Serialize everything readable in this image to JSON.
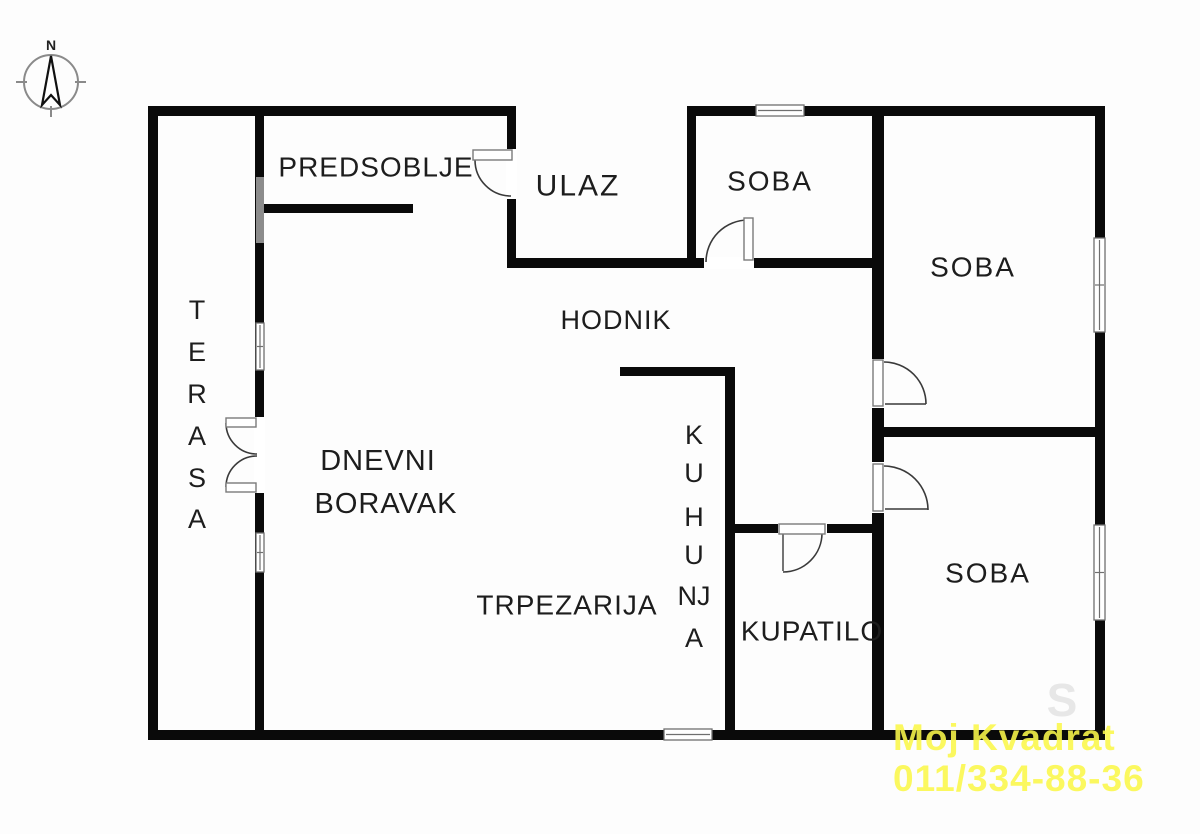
{
  "plan": {
    "bg": "#fdfdfd",
    "wall_color": "#0a0a0a",
    "line_color": "#3a3a3a",
    "window_stroke": "#6f6f6f",
    "label_color": "#1d1d1d",
    "ghosts": [
      {
        "text": "S",
        "x": 1062,
        "y": 716,
        "size": 46,
        "color": "#e7e7e7"
      }
    ],
    "walls": [
      {
        "name": "top-wall-left",
        "x": 148,
        "y": 106,
        "w": 367,
        "h": 10
      },
      {
        "name": "top-wall-right",
        "x": 687,
        "y": 106,
        "w": 418,
        "h": 10
      },
      {
        "name": "left-outer-wall",
        "x": 148,
        "y": 106,
        "w": 10,
        "h": 634
      },
      {
        "name": "right-outer-wall",
        "x": 1095,
        "y": 106,
        "w": 10,
        "h": 634
      },
      {
        "name": "bottom-outer-wall",
        "x": 148,
        "y": 730,
        "w": 957,
        "h": 10
      },
      {
        "name": "terrace-wall",
        "x": 255,
        "y": 106,
        "w": 9,
        "h": 634
      },
      {
        "name": "entry-wall",
        "x": 507,
        "y": 106,
        "w": 9,
        "h": 162
      },
      {
        "name": "soba1-left-wall",
        "x": 687,
        "y": 106,
        "w": 9,
        "h": 162
      },
      {
        "name": "hall-top-wall",
        "x": 507,
        "y": 258,
        "w": 377,
        "h": 10
      },
      {
        "name": "rooms-left-wall",
        "x": 872,
        "y": 106,
        "w": 12,
        "h": 634
      },
      {
        "name": "soba-divider-wall",
        "x": 872,
        "y": 427,
        "w": 233,
        "h": 10
      },
      {
        "name": "predsoblje-wall",
        "x": 262,
        "y": 204,
        "w": 151,
        "h": 9
      },
      {
        "name": "kitchen-top-wall",
        "x": 620,
        "y": 367,
        "w": 114,
        "h": 9
      },
      {
        "name": "kitchen-right-wall",
        "x": 725,
        "y": 367,
        "w": 10,
        "h": 373
      },
      {
        "name": "bathroom-top-wall",
        "x": 725,
        "y": 524,
        "w": 159,
        "h": 9
      }
    ],
    "solids": [
      {
        "name": "terrace-window-upper",
        "x": 256,
        "y": 177,
        "w": 8,
        "h": 66,
        "color": "#8c8c8c"
      }
    ],
    "windows": [
      {
        "name": "soba1-top-window",
        "x": 756,
        "y": 105,
        "w": 48,
        "h": 11,
        "o": "h"
      },
      {
        "name": "soba2-right-window",
        "x": 1094,
        "y": 238,
        "w": 11,
        "h": 94,
        "o": "v"
      },
      {
        "name": "soba3-right-window",
        "x": 1094,
        "y": 525,
        "w": 11,
        "h": 95,
        "o": "v"
      },
      {
        "name": "kitchen-bottom-window",
        "x": 664,
        "y": 729,
        "w": 48,
        "h": 11,
        "o": "h"
      },
      {
        "name": "terrace-window-mid",
        "x": 256,
        "y": 323,
        "w": 8,
        "h": 47,
        "o": "v"
      },
      {
        "name": "terrace-window-lower",
        "x": 256,
        "y": 533,
        "w": 8,
        "h": 39,
        "o": "v"
      }
    ],
    "doors": [
      {
        "name": "entry-door",
        "gap": {
          "x": 506,
          "y": 149,
          "w": 11,
          "h": 50
        },
        "leaf": {
          "x": 473,
          "y": 150,
          "w": 39,
          "h": 10
        },
        "arc": "M 475 160 A 36 36 0 0 0 511 196"
      },
      {
        "name": "soba1-door",
        "gap": {
          "x": 704,
          "y": 257,
          "w": 50,
          "h": 12
        },
        "leaf": {
          "x": 744,
          "y": 218,
          "w": 9,
          "h": 42
        },
        "arc": "M 706 262 A 42 42 0 0 1 748 220"
      },
      {
        "name": "soba2-door",
        "gap": {
          "x": 871,
          "y": 359,
          "w": 14,
          "h": 49
        },
        "leaf": {
          "x": 873,
          "y": 360,
          "w": 10,
          "h": 46
        },
        "arc": "M 884 362 A 42 42 0 0 1 926 404",
        "line": [
          885,
          404,
          926,
          404
        ]
      },
      {
        "name": "soba3-door",
        "gap": {
          "x": 871,
          "y": 462,
          "w": 14,
          "h": 51
        },
        "leaf": {
          "x": 873,
          "y": 464,
          "w": 10,
          "h": 47
        },
        "arc": "M 884 466 A 44 44 0 0 1 928 510",
        "line": [
          885,
          509,
          928,
          509
        ]
      },
      {
        "name": "bathroom-door",
        "gap": {
          "x": 778,
          "y": 523,
          "w": 49,
          "h": 11
        },
        "leaf": {
          "x": 779,
          "y": 524,
          "w": 46,
          "h": 10
        },
        "arc": "M 783 572 A 39 39 0 0 0 822 533",
        "line": [
          783,
          534,
          783,
          571
        ]
      },
      {
        "name": "balcony-door-upper",
        "gap": {
          "x": 254,
          "y": 417,
          "w": 11,
          "h": 76
        },
        "leaf": {
          "x": 226,
          "y": 418,
          "w": 30,
          "h": 9
        },
        "arc": "M 226 423 A 31 31 0 0 0 257 454"
      },
      {
        "name": "balcony-door-lower",
        "gap": null,
        "leaf": {
          "x": 226,
          "y": 483,
          "w": 30,
          "h": 9
        },
        "arc": "M 226 487 A 31 31 0 0 1 257 456"
      }
    ],
    "labels": [
      {
        "name": "label-predsoblje",
        "text": "PREDSOBLJE",
        "x": 376,
        "y": 167,
        "size": 28,
        "ls": 1
      },
      {
        "name": "label-ulaz",
        "text": "ULAZ",
        "x": 578,
        "y": 186,
        "size": 30,
        "ls": 2
      },
      {
        "name": "label-soba-1",
        "text": "SOBA",
        "x": 770,
        "y": 181,
        "size": 28,
        "ls": 2
      },
      {
        "name": "label-soba-2",
        "text": "SOBA",
        "x": 973,
        "y": 267,
        "size": 28,
        "ls": 2
      },
      {
        "name": "label-hodnik",
        "text": "HODNIK",
        "x": 616,
        "y": 320,
        "size": 27,
        "ls": 1
      },
      {
        "name": "label-dnevni",
        "text": "DNEVNI",
        "x": 378,
        "y": 461,
        "size": 29,
        "ls": 1
      },
      {
        "name": "label-boravak",
        "text": "BORAVAK",
        "x": 386,
        "y": 504,
        "size": 29,
        "ls": 1
      },
      {
        "name": "label-trpezarija",
        "text": "TRPEZARIJA",
        "x": 567,
        "y": 605,
        "size": 28,
        "ls": 1
      },
      {
        "name": "label-kupatilo",
        "text": "KUPATILO",
        "x": 812,
        "y": 631,
        "size": 28,
        "ls": 1
      },
      {
        "name": "label-soba-3",
        "text": "SOBA",
        "x": 988,
        "y": 573,
        "size": 28,
        "ls": 2
      }
    ],
    "vlabels": [
      {
        "name": "label-terasa",
        "x": 197,
        "size": 27,
        "letters": [
          {
            "t": "T",
            "y": 310
          },
          {
            "t": "E",
            "y": 352
          },
          {
            "t": "R",
            "y": 394
          },
          {
            "t": "A",
            "y": 436
          },
          {
            "t": "S",
            "y": 478
          },
          {
            "t": "A",
            "y": 519
          }
        ]
      },
      {
        "name": "label-kuhinja",
        "x": 694,
        "size": 27,
        "letters": [
          {
            "t": "K",
            "y": 435
          },
          {
            "t": "U",
            "y": 473
          },
          {
            "t": "H",
            "y": 517
          },
          {
            "t": "U",
            "y": 555
          },
          {
            "t": "NJ",
            "y": 596
          },
          {
            "t": "A",
            "y": 638
          }
        ]
      }
    ]
  },
  "compass": {
    "label": "N",
    "cx": 51,
    "cy": 82,
    "r": 27,
    "circle_color": "#8a8a8a",
    "needle_color": "#111111"
  },
  "watermark": {
    "line1": "Moj Kvadrat",
    "line2": "011/334-88-36",
    "color": "#fbf84a"
  }
}
